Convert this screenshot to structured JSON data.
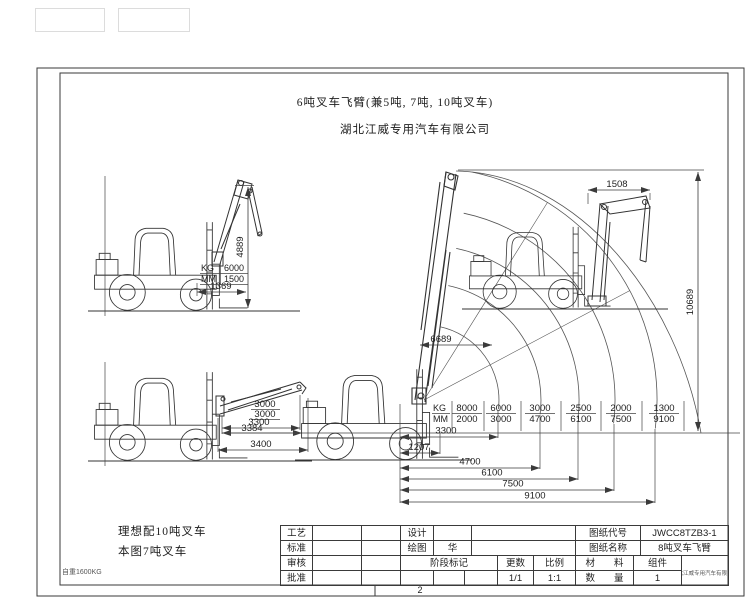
{
  "page": {
    "number": "2"
  },
  "header": {
    "title": "6吨叉车飞臂(兼5吨, 7吨, 10吨叉车)",
    "company": "湖北江威专用汽车有限公司"
  },
  "notes": {
    "ideal": "理想配10吨叉车",
    "current": "本图7吨叉车",
    "weight": "自重1600KG"
  },
  "elevated_view": {
    "dim_height": "4889",
    "dim_reach": "1369",
    "kg_label": "KG",
    "kg_value": "6000",
    "mm_label": "MM",
    "mm_value": "1500"
  },
  "horizontal_view": {
    "dim_a": "3000",
    "dim_b": "3000",
    "dim_3300": "3300",
    "dim_3384": "3384",
    "dim_3400": "3400"
  },
  "main_view": {
    "dim_1508": "1508",
    "dim_10689": "10689",
    "dim_6689": "6689",
    "dim_3300": "3300",
    "dim_1207": "1207",
    "dim_4700": "4700",
    "dim_6100": "6100",
    "dim_7500": "7500",
    "dim_9100": "9100",
    "load_chart": {
      "kg_label": "KG",
      "mm_label": "MM",
      "kg": [
        "8000",
        "6000",
        "3000",
        "2500",
        "2000",
        "1300"
      ],
      "mm": [
        "2000",
        "3000",
        "4700",
        "6100",
        "7500",
        "9100"
      ]
    }
  },
  "title_block": {
    "craft": "工艺",
    "standard": "标准",
    "review": "审核",
    "approve": "批准",
    "design": "设计",
    "draw": "绘图",
    "draw_value": "华",
    "stage_mark": "阶段标记",
    "sheets": "更数",
    "sheets_value": "1/1",
    "scale": "比例",
    "scale_value": "1:1",
    "code_label": "图纸代号",
    "code_value": "JWCC8TZB3-1",
    "name_label": "图纸名称",
    "name_value": "8吨叉车飞臂",
    "material": "材　　料",
    "component": "组件",
    "quantity": "数　　量",
    "quantity_value": "1",
    "corner_note": "湖北江威专用汽车有限公司"
  }
}
